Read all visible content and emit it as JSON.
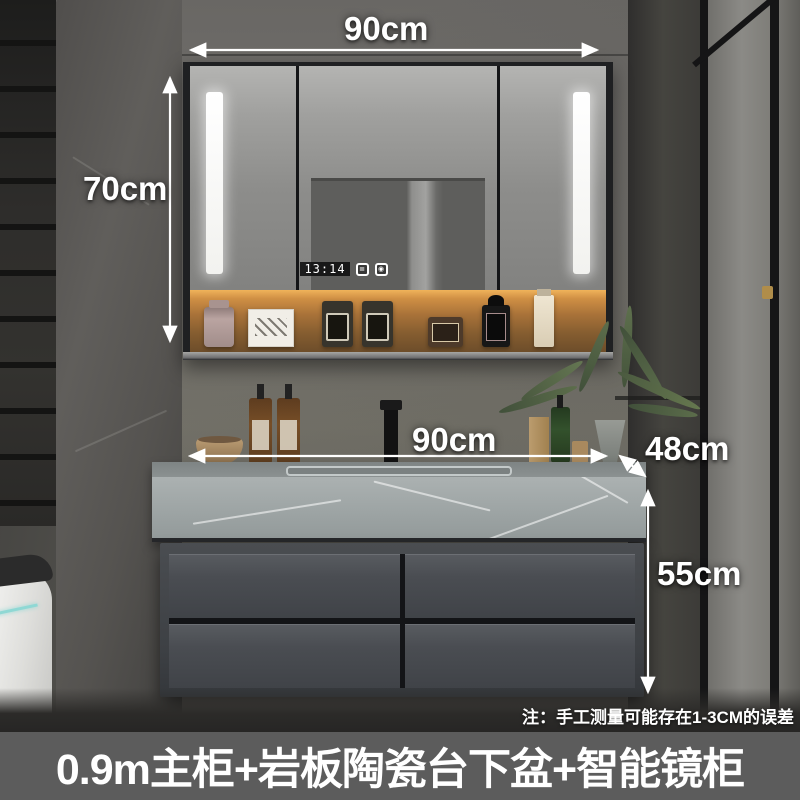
{
  "banner": {
    "title": "0.9m主柜+岩板陶瓷台下盆+智能镜柜"
  },
  "note": "注：手工测量可能存在1-3CM的误差",
  "annotations": {
    "mirror_width": "90cm",
    "mirror_height": "70cm",
    "vanity_width": "90cm",
    "counter_depth": "48cm",
    "vanity_height": "55cm"
  },
  "mirror_cabinet": {
    "clock_time": "13:14",
    "display_icons": [
      "≣",
      "◉"
    ]
  },
  "colors": {
    "annotation_text": "#ffffff",
    "banner_bg": "#5c5c5c",
    "shelf_glow": "#c98c3f",
    "counter_stone": "#a0a7a7",
    "cabinet_body": "#45484c",
    "led_white": "#f7f7f4"
  }
}
